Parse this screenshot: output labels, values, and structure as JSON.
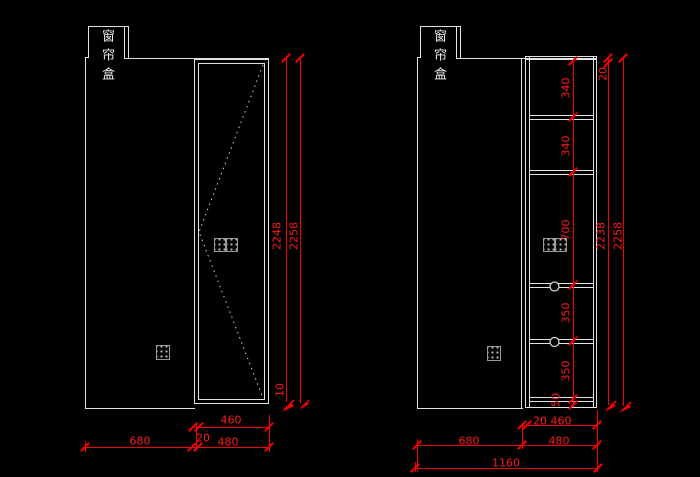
{
  "left_view": {
    "curtain_box_label": "窗帘盒",
    "dim_door_height": "2248",
    "dim_total_height": "2258",
    "dim_bottom_gap": "10",
    "dim_door_clear_width": "460",
    "dim_gap": "20",
    "dim_door_width": "480",
    "dim_panel_width": "680"
  },
  "right_view": {
    "curtain_box_label": "窗帘盒",
    "dim_top_board": "20",
    "dim_section_1": "340",
    "dim_section_2": "340",
    "dim_section_3": "700",
    "dim_section_4": "350",
    "dim_section_5": "350",
    "dim_bottom_board": "50",
    "dim_inner_height": "2238",
    "dim_total_height": "2258",
    "dim_gap": "20",
    "dim_clear_width": "460",
    "dim_panel_width": "680",
    "dim_cabinet_width": "480",
    "dim_total_width": "1160"
  },
  "colors": {
    "background": "#000000",
    "outline": "#e2e2e2",
    "dimension": "#ff0000",
    "icon_outline": "#9a9a9a"
  }
}
